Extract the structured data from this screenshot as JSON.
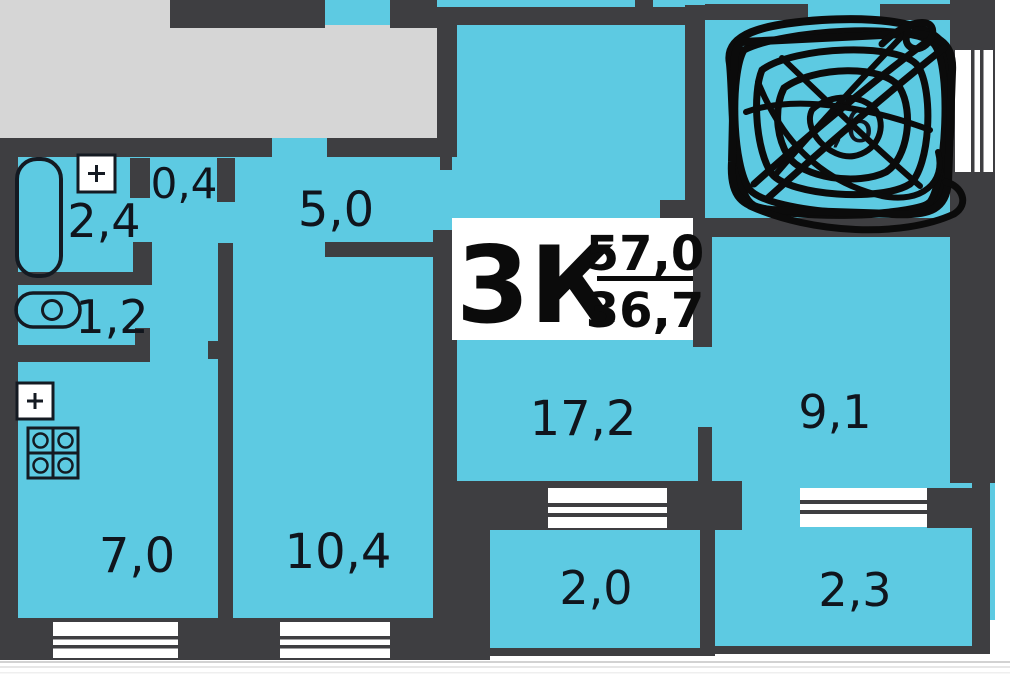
{
  "plan": {
    "type": "apartment-floor-plan",
    "title": {
      "rooms_code": "3К",
      "total_area": "57,0",
      "living_area": "36,7"
    },
    "rooms": {
      "storage": {
        "area": "0,4"
      },
      "bathroom": {
        "area": "2,4"
      },
      "hallway": {
        "area": "5,0"
      },
      "wc": {
        "area": "1,2"
      },
      "kitchen": {
        "area": "7,0"
      },
      "bedroom": {
        "area": "10,4"
      },
      "living_room": {
        "area": "17,2"
      },
      "bedroom2": {
        "area": "9,1"
      },
      "balcony_left": {
        "area": "2,0"
      },
      "balcony_right": {
        "area": "2,3"
      },
      "scribbled_room": {
        "visible_fragment": ",6"
      }
    },
    "colors": {
      "room_fill": "#5dcae2",
      "wall": "#3e3e41",
      "landing": "#d6d6d6",
      "window": "#ffffff",
      "text": "#10151d",
      "scribble": "#0b0b0b",
      "background": "#ffffff"
    }
  }
}
